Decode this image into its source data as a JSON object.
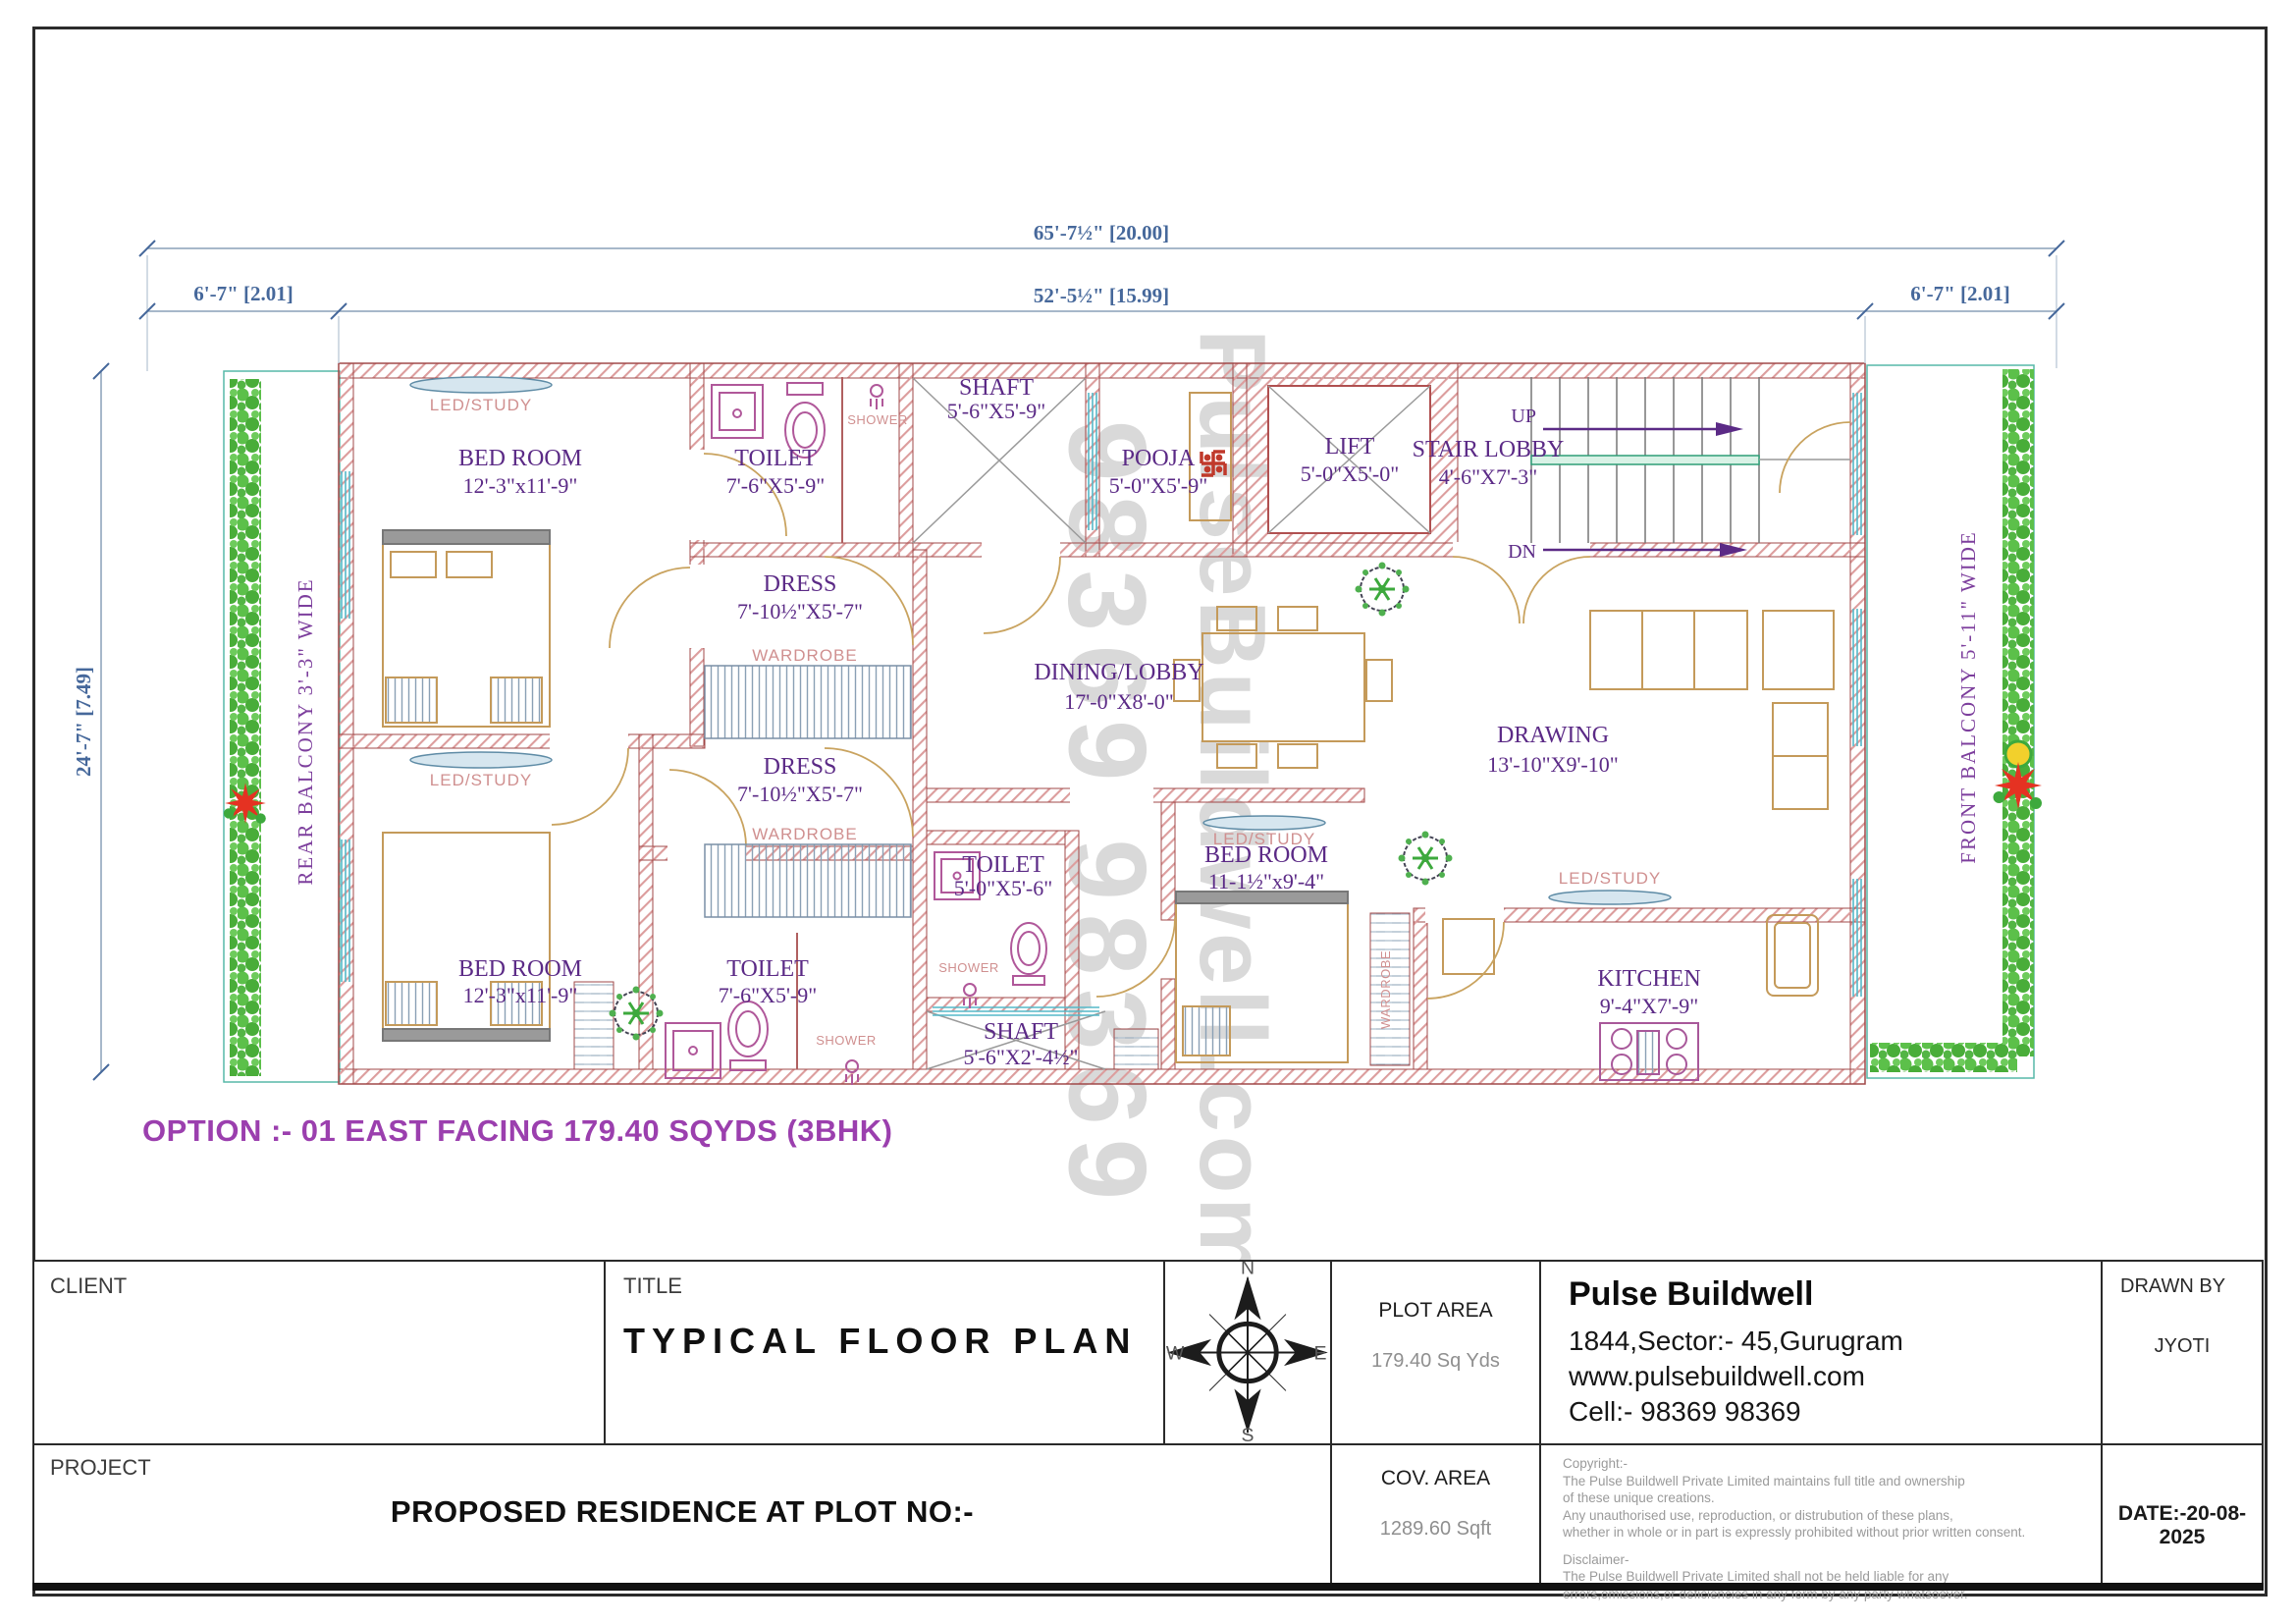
{
  "dimensions": {
    "top_total": "65'-7½\" [20.00]",
    "top_inner": "52'-5½\" [15.99]",
    "top_left": "6'-7\" [2.01]",
    "top_right": "6'-7\" [2.01]",
    "left_vertical": "24'-7\" [7.49]"
  },
  "balconies": {
    "rear": "REAR  BALCONY 3'-3\" WIDE",
    "front": "FRONT  BALCONY 5'-11\" WIDE"
  },
  "rooms": [
    {
      "name": "BED ROOM",
      "size": "12'-3\"x11'-9\""
    },
    {
      "name": "TOILET",
      "size": "7'-6\"X5'-9\""
    },
    {
      "name": "SHAFT",
      "size": "5'-6\"X5'-9\""
    },
    {
      "name": "POOJA",
      "size": "5'-0\"X5'-9\""
    },
    {
      "name": "LIFT",
      "size": "5'-0\"X5'-0\""
    },
    {
      "name": "STAIR LOBBY",
      "size": "4'-6\"X7'-3\""
    },
    {
      "name": "DRESS",
      "size": "7'-10½\"X5'-7\""
    },
    {
      "name": "DRESS",
      "size": "7'-10½\"X5'-7\""
    },
    {
      "name": "DINING/LOBBY",
      "size": "17'-0\"X8'-0\""
    },
    {
      "name": "DRAWING",
      "size": "13'-10\"X9'-10\""
    },
    {
      "name": "BED ROOM",
      "size": "11-1½\"x9'-4\""
    },
    {
      "name": "TOILET",
      "size": "5'-0\"X5'-6\""
    },
    {
      "name": "SHAFT",
      "size": "5'-6\"X2'-4½\""
    },
    {
      "name": "BED ROOM",
      "size": "12'-3\"x11'-9\""
    },
    {
      "name": "TOILET",
      "size": "7'-6\"X5'-9\""
    },
    {
      "name": "KITCHEN",
      "size": "9'-4\"X7'-9\""
    }
  ],
  "annotations": {
    "led_study": "LED/STUDY",
    "wardrobe": "WARDROBE",
    "shower": "SHOWER",
    "up": "UP",
    "dn": "DN"
  },
  "watermark": {
    "numbers": "98369 98369",
    "name": "PulseBuildwell.com"
  },
  "option_note": "OPTION :- 01 EAST FACING 179.40 SQYDS (3BHK)",
  "compass": {
    "n": "N",
    "e": "E",
    "s": "S",
    "w": "W"
  },
  "title_block": {
    "client_label": "CLIENT",
    "title_label": "TITLE",
    "title_value": "TYPICAL  FLOOR PLAN",
    "project_label": "PROJECT",
    "project_value": "PROPOSED RESIDENCE AT PLOT NO:-",
    "plot_area_label": "PLOT AREA",
    "plot_area_value": "179.40 Sq Yds",
    "cov_area_label": "COV. AREA",
    "cov_area_value": "1289.60 Sqft",
    "company": "Pulse Buildwell",
    "address": "1844,Sector:- 45,Gurugram",
    "website": "www.pulsebuildwell.com",
    "cell": "Cell:- 98369 98369",
    "drawn_by_label": "DRAWN BY",
    "drawn_by_value": "JYOTI",
    "date": "DATE:-20-08-2025",
    "copyright": [
      "Copyright:-",
      "The Pulse Buildwell Private Limited maintains full title and ownership",
      " of these unique creations.",
      "Any unauthorised use, reproduction, or distrubution of these plans,",
      "whether in whole or in part is expressly prohibited without prior written consent.",
      "Disclaimer-",
      "The Pulse Buildwell Private Limited shall not be held liable for any",
      "errors,omissions,or deficiencies in any form by any party whatsoever."
    ]
  },
  "colors": {
    "wall": "#b25b5b",
    "dimension": "#46689b",
    "room_label": "#5b2a86",
    "annotation": "#d09090",
    "option_note": "#9b3fae",
    "hedge": "#58bb45",
    "fixture": "#b0589a",
    "furniture": "#c49a5a",
    "window": "#55b8c8",
    "watermark": "#d9d9d9"
  }
}
